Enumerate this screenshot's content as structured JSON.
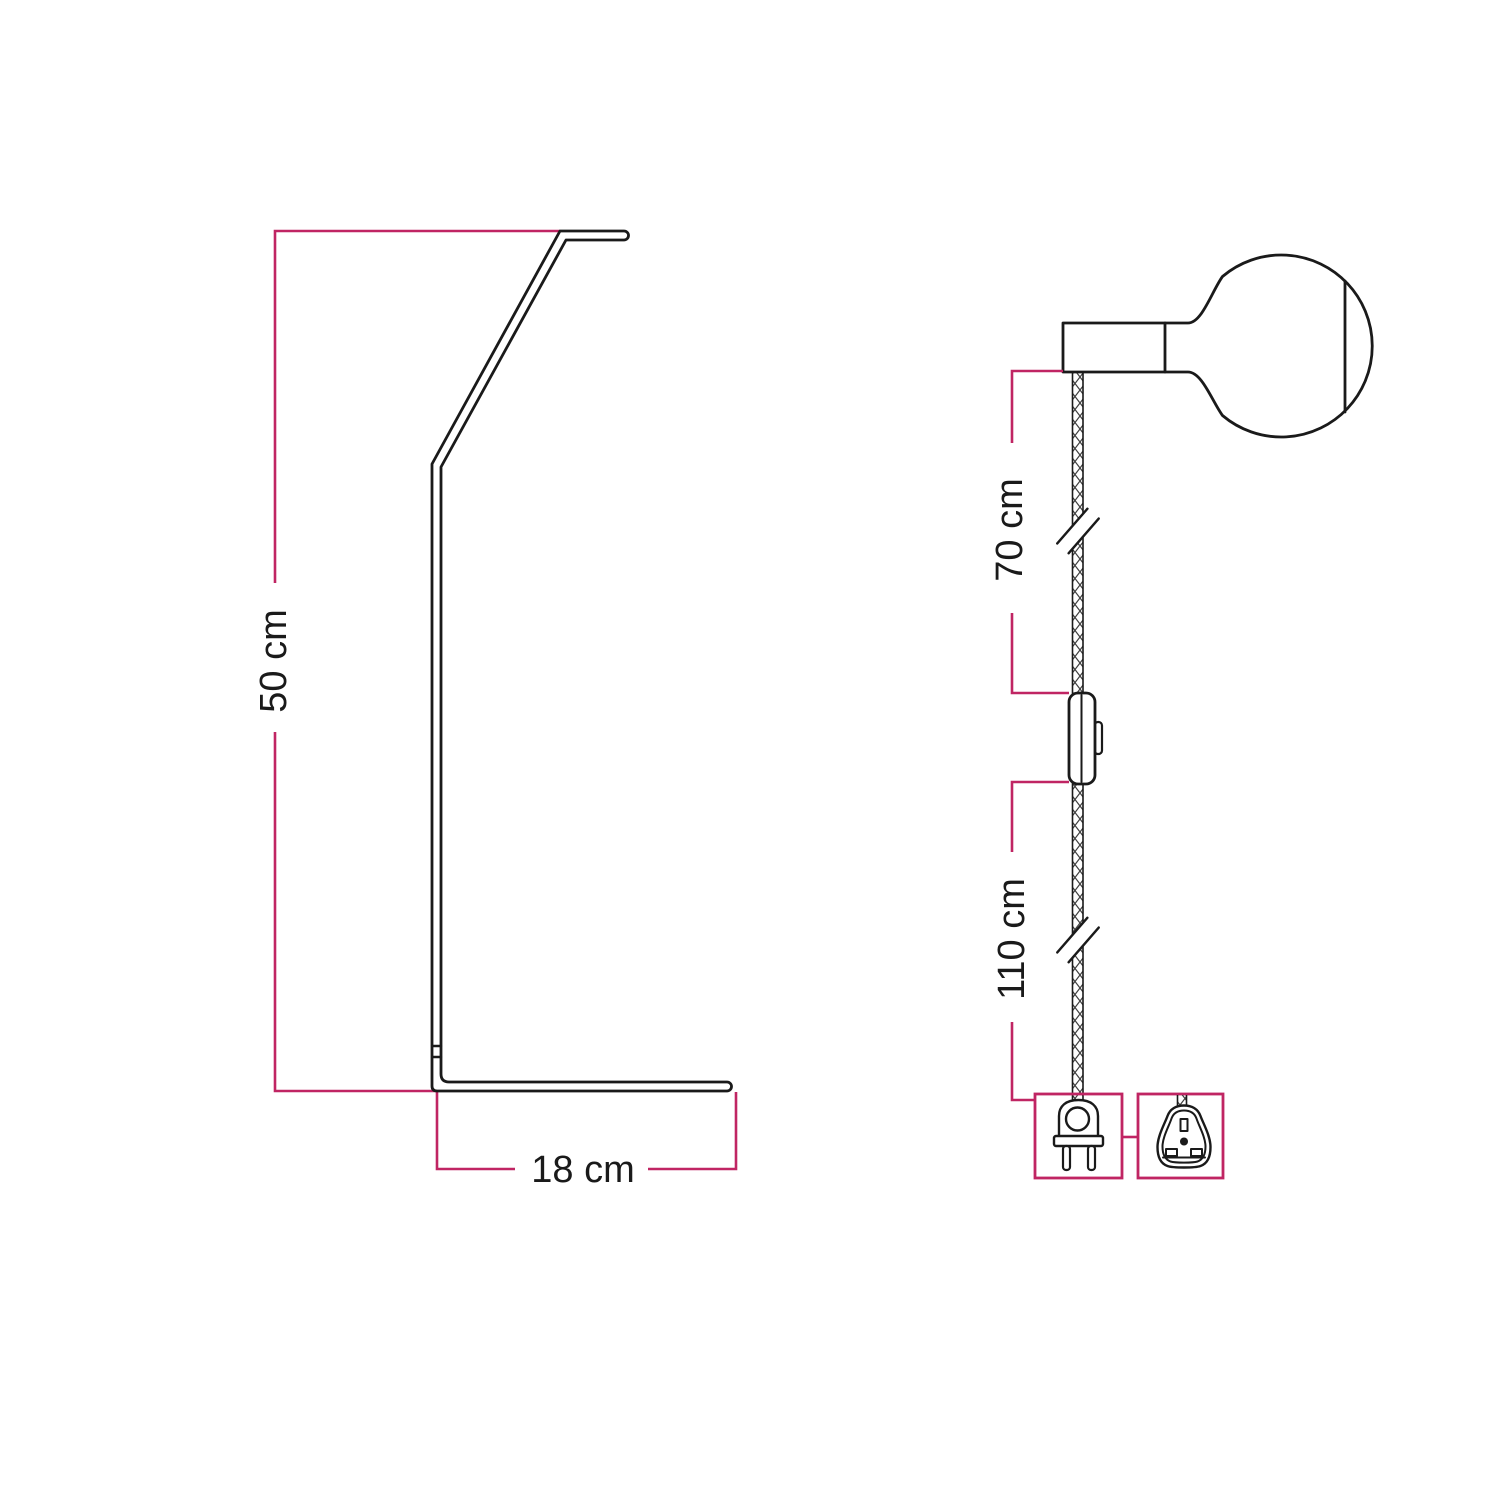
{
  "title": "Lamp dimensions technical diagram",
  "colors": {
    "ink": "#1a1a1a",
    "dimension_accent": "#c02563",
    "background": "#ffffff"
  },
  "views": {
    "stand": {
      "name": "curved stand side profile",
      "dimensions": {
        "height": {
          "label": "50 cm",
          "orientation": "vertical"
        },
        "base_depth": {
          "label": "18 cm",
          "orientation": "horizontal"
        }
      }
    },
    "pendant": {
      "name": "socket, globe bulb and power cord",
      "dimensions": {
        "cord_upper": {
          "label": "70 cm",
          "orientation": "vertical"
        },
        "cord_lower": {
          "label": "110 cm",
          "orientation": "vertical"
        }
      }
    }
  },
  "icons": {
    "stand": "lamp-stand-profile-icon",
    "socket": "lamp-socket-icon",
    "bulb": "globe-bulb-icon",
    "cable": "textile-cable-icon",
    "break": "cable-break-icon",
    "switch": "inline-switch-icon",
    "plug_eu": "europlug-icon",
    "plug_uk": "uk-plug-adapter-icon"
  }
}
